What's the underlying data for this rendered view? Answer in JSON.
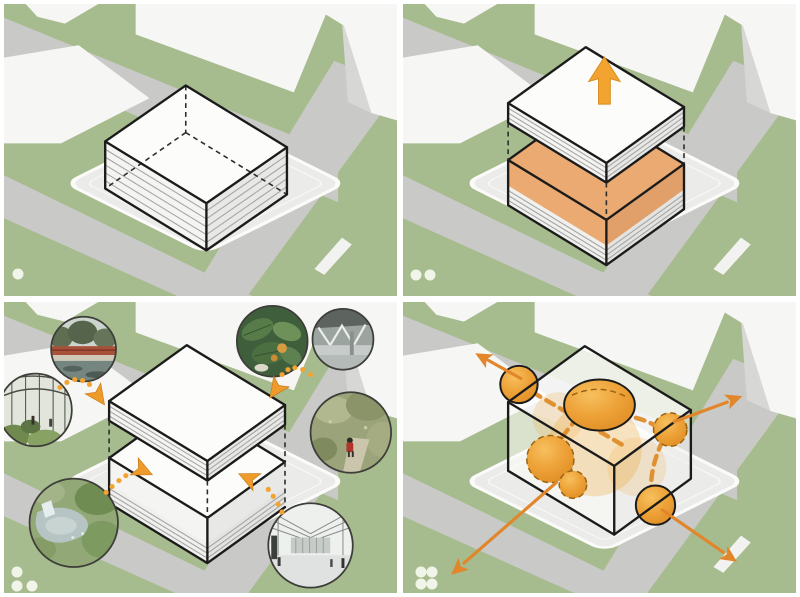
{
  "figure": {
    "kind": "architectural-massing-concept-diagram",
    "panel_count": 4
  },
  "colors": {
    "green": "#a7bc8e",
    "road": "#c9c9c7",
    "block": "#f6f6f4",
    "shadow": "#d7d7d5",
    "pad": "#ebebe9",
    "padline": "#fbfbfa",
    "outline": "#1b1b1b",
    "wallA": "#f4f4f2",
    "wallB": "#e8e8e6",
    "stripe": "#a5a5a3",
    "orangeA": "#eaaa72",
    "orangeB": "#e1a069",
    "accent": "#f2a330",
    "dart": "#ef9b2b",
    "dash": "#dd8a25",
    "flow": "#e1862a",
    "blob": "#f0a83c",
    "dot": "#f4f8ee"
  },
  "panels": [
    {
      "name": "existing-massing",
      "step": 1,
      "dots": [
        [
          14,
          275
        ]
      ],
      "icons": [
        "massing-box-icon"
      ]
    },
    {
      "name": "lift-roof-insert-void",
      "step": 2,
      "dots": [
        [
          13,
          276
        ],
        [
          27,
          276
        ]
      ],
      "icons": [
        "split-massing-icon",
        "up-arrow-icon"
      ]
    },
    {
      "name": "program-reference-insets",
      "step": 3,
      "dots": [
        [
          13,
          276
        ],
        [
          13,
          290
        ],
        [
          28,
          290
        ]
      ],
      "icons": [
        "split-massing-icon",
        "dotted-arc-arrow-icon"
      ],
      "insets": [
        "waterside-red-bridge-photo",
        "greenhouse-interior-photo",
        "aerial-pond-garden-photo",
        "tropical-foliage-photo",
        "bridge-underside-photo",
        "forest-trail-hiker-photo",
        "atrium-hall-photo"
      ]
    },
    {
      "name": "circulation-bubble-flows",
      "step": 4,
      "dots": [
        [
          18,
          276
        ],
        [
          30,
          276
        ],
        [
          18,
          288
        ],
        [
          30,
          288
        ]
      ],
      "icons": [
        "transparent-box-icon",
        "flow-bubble-icon",
        "outward-arrow-icon"
      ]
    }
  ]
}
